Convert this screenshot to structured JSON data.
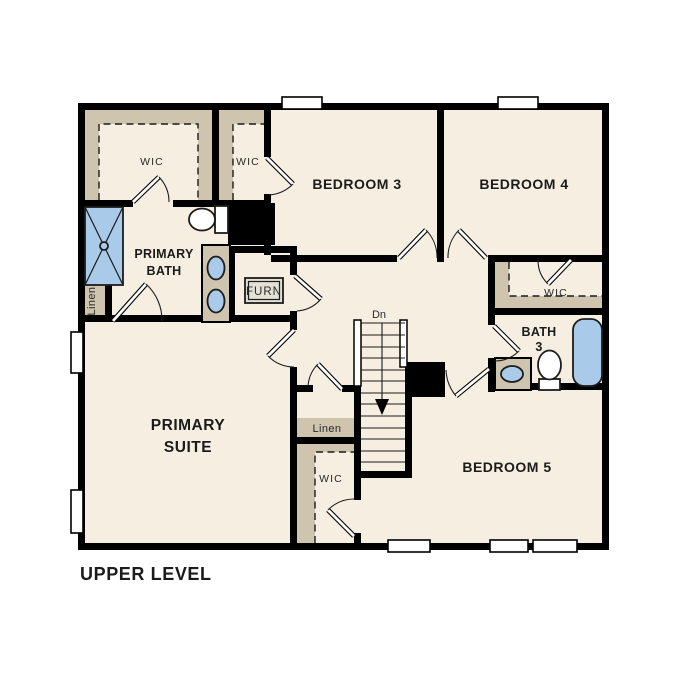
{
  "title": "UPPER LEVEL",
  "rooms": {
    "primary_suite": {
      "line1": "PRIMARY",
      "line2": "SUITE"
    },
    "primary_bath": {
      "line1": "PRIMARY",
      "line2": "BATH"
    },
    "bedroom_3": {
      "label": "BEDROOM 3"
    },
    "bedroom_4": {
      "label": "BEDROOM 4"
    },
    "bedroom_5": {
      "label": "BEDROOM 5"
    },
    "bath_3": {
      "line1": "BATH",
      "line2": "3"
    },
    "wic_primary": {
      "label": "WIC"
    },
    "wic_bedroom_3": {
      "label": "WIC"
    },
    "wic_bedroom_4": {
      "label": "WIC"
    },
    "wic_hall": {
      "label": "WIC"
    },
    "linen_bath": {
      "label": "Linen"
    },
    "linen_hall": {
      "label": "Linen"
    },
    "furnace_closet": {
      "label": "FURN"
    }
  },
  "stairs": {
    "direction_label": "Dn"
  },
  "fixtures": [
    "shower",
    "toilet",
    "double-sink-vanity",
    "bathtub",
    "single-sink-vanity",
    "toilet"
  ],
  "colors": {
    "background": "#ffffff",
    "floor": "#f5eee1",
    "closet_shelving": "#cfc4ad",
    "fixture_blue": "#a9cae8",
    "walls": "#000000",
    "text": "#1b1b1b"
  }
}
